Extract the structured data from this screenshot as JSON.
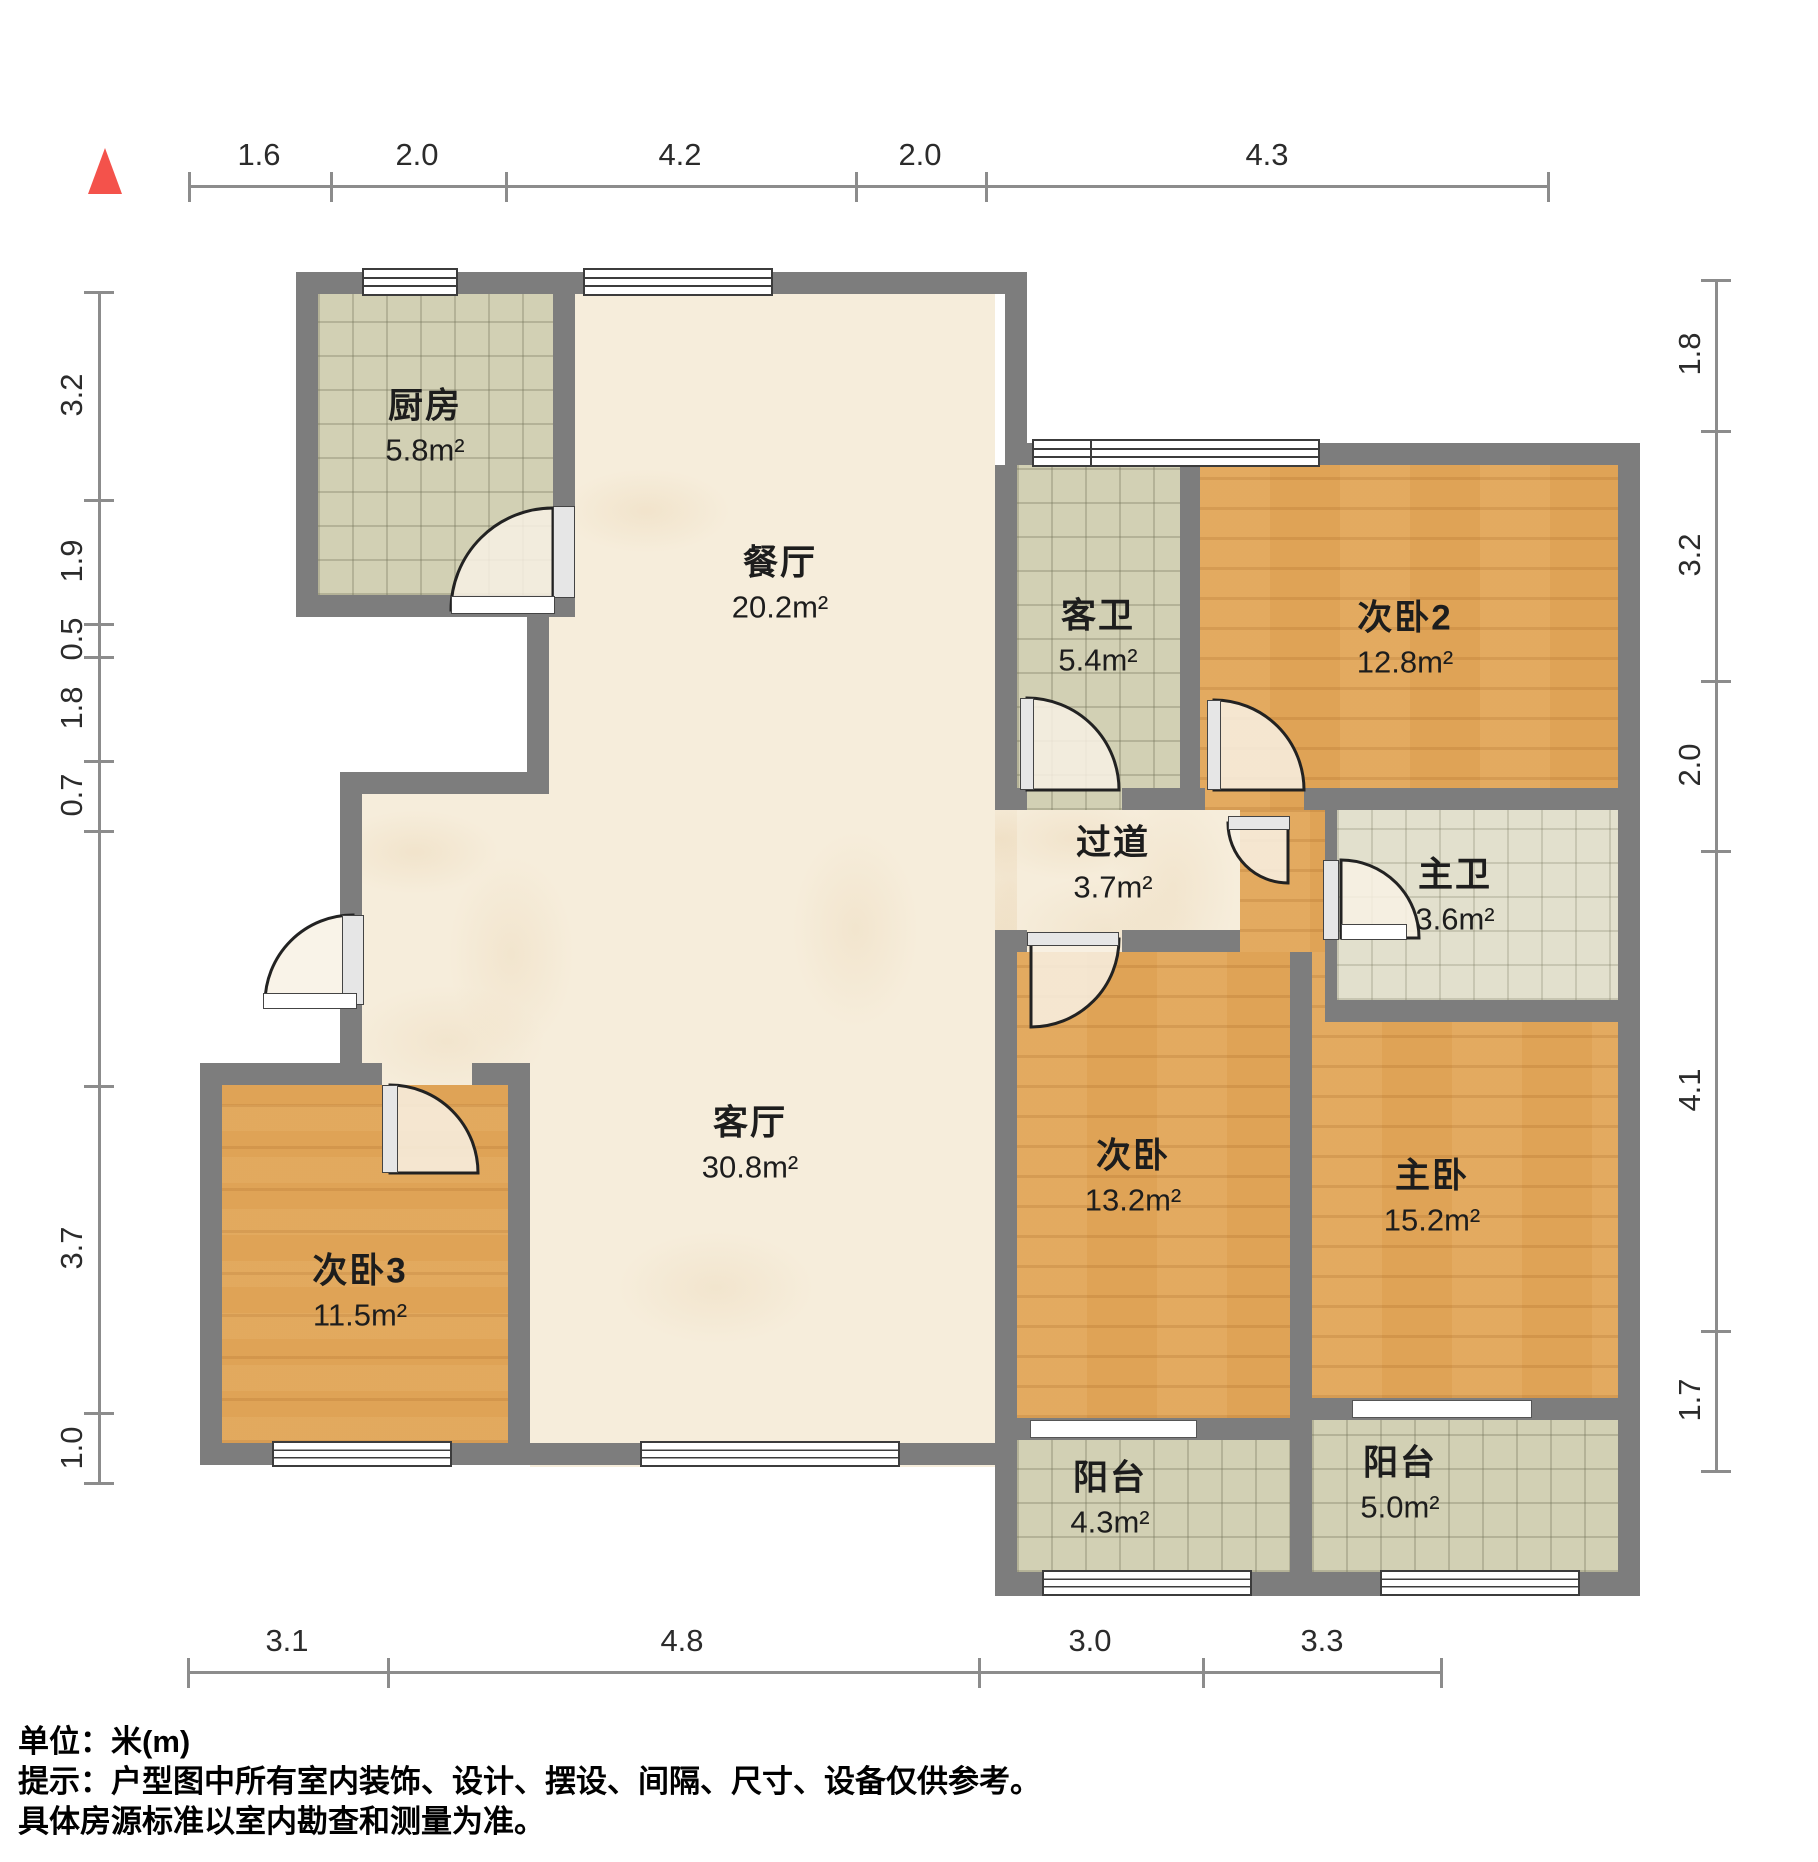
{
  "rooms": {
    "kitchen": {
      "name": "厨房",
      "area": "5.8m²"
    },
    "dining": {
      "name": "餐厅",
      "area": "20.2m²"
    },
    "guest_bath": {
      "name": "客卫",
      "area": "5.4m²"
    },
    "bedroom2": {
      "name": "次卧2",
      "area": "12.8m²"
    },
    "corridor": {
      "name": "过道",
      "area": "3.7m²"
    },
    "master_bath": {
      "name": "主卫",
      "area": "3.6m²"
    },
    "living": {
      "name": "客厅",
      "area": "30.8m²"
    },
    "bedroom": {
      "name": "次卧",
      "area": "13.2m²"
    },
    "master_bedroom": {
      "name": "主卧",
      "area": "15.2m²"
    },
    "bedroom3": {
      "name": "次卧3",
      "area": "11.5m²"
    },
    "balcony_left": {
      "name": "阳台",
      "area": "4.3m²"
    },
    "balcony_right": {
      "name": "阳台",
      "area": "5.0m²"
    }
  },
  "dimensions": {
    "top": [
      "1.6",
      "2.0",
      "4.2",
      "2.0",
      "4.3"
    ],
    "left": [
      "3.2",
      "1.9",
      "0.5",
      "1.8",
      "0.7",
      "3.7",
      "1.0"
    ],
    "right": [
      "1.8",
      "3.2",
      "2.0",
      "4.1",
      "1.7"
    ],
    "bottom": [
      "3.1",
      "4.8",
      "3.0",
      "3.3"
    ]
  },
  "footer": {
    "unit": "单位：米(m)",
    "note1": "提示：户型图中所有室内装饰、设计、摆设、间隔、尺寸、设备仅供参考。",
    "note2": "具体房源标准以室内勘查和测量为准。"
  },
  "colors": {
    "wall": "#7d7d7d",
    "wood_floor": "#dfa356",
    "tile_floor": "#d2d0b4",
    "marble_floor": "#f6eddb",
    "north_arrow": "#f4524b",
    "dimension_line": "#8c8c8c"
  }
}
